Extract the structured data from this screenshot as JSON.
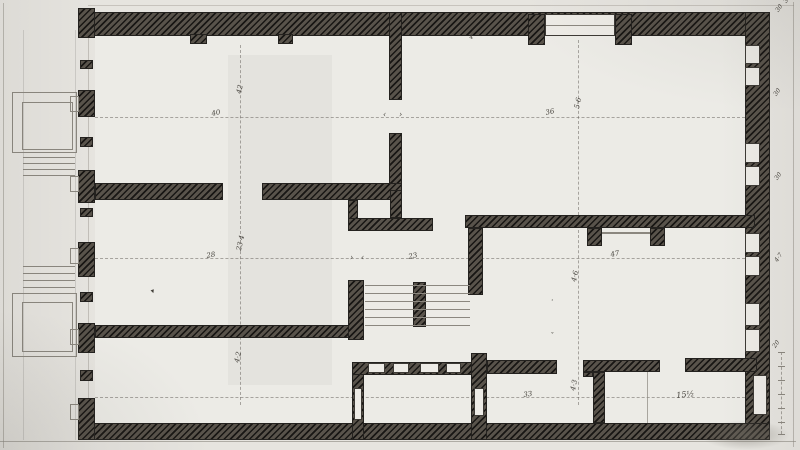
{
  "document": {
    "kind": "scanned hand-drawn architectural floor plan, hatched masonry walls",
    "colors": {
      "paper": "#e6e4df",
      "room_fill": "#ecebe6",
      "wall_ink_dark": "#24221f",
      "wall_ink_mid": "#5a544c",
      "pencil_line": "#8b877f",
      "annotation_ink": "#44413b"
    }
  },
  "annotations": [
    {
      "name": "dim-40",
      "text": "40",
      "x": 211,
      "y": 111,
      "rot": -12,
      "size": 7
    },
    {
      "name": "dim-42",
      "text": "42",
      "x": 236,
      "y": 93,
      "rot": -78,
      "size": 7
    },
    {
      "name": "mark-plus",
      "text": "+",
      "x": 238,
      "y": 16,
      "rot": 0,
      "size": 6
    },
    {
      "name": "dim-36",
      "text": "36",
      "x": 545,
      "y": 110,
      "rot": -12,
      "size": 7
    },
    {
      "name": "dim-5-6",
      "text": "5·6",
      "x": 574,
      "y": 108,
      "rot": -78,
      "size": 7
    },
    {
      "name": "dim-4-door",
      "text": "4",
      "x": 469,
      "y": 35,
      "rot": -10,
      "size": 6
    },
    {
      "name": "arrow-left-top",
      "text": "‹",
      "x": 383,
      "y": 111,
      "rot": 0,
      "size": 8
    },
    {
      "name": "arrow-right-top",
      "text": "›",
      "x": 399,
      "y": 111,
      "rot": 0,
      "size": 8
    },
    {
      "name": "dim-28",
      "text": "28",
      "x": 206,
      "y": 253,
      "rot": -10,
      "size": 7
    },
    {
      "name": "dim-23-4",
      "text": "23·4",
      "x": 236,
      "y": 250,
      "rot": -78,
      "size": 7
    },
    {
      "name": "arrow-right-stair",
      "text": "›",
      "x": 350,
      "y": 254,
      "rot": 0,
      "size": 8
    },
    {
      "name": "arrow-left-stair",
      "text": "‹",
      "x": 361,
      "y": 254,
      "rot": 0,
      "size": 8
    },
    {
      "name": "dim-23",
      "text": "23",
      "x": 408,
      "y": 254,
      "rot": -12,
      "size": 7
    },
    {
      "name": "dim-47",
      "text": "47",
      "x": 610,
      "y": 252,
      "rot": -12,
      "size": 7
    },
    {
      "name": "dim-4-6",
      "text": "4·6",
      "x": 571,
      "y": 281,
      "rot": -78,
      "size": 7
    },
    {
      "name": "ink-mark",
      "text": "▾",
      "x": 150,
      "y": 289,
      "rot": -20,
      "size": 7
    },
    {
      "name": "dim-33",
      "text": "33",
      "x": 523,
      "y": 392,
      "rot": -8,
      "size": 7
    },
    {
      "name": "dim-4-3",
      "text": "4·3",
      "x": 570,
      "y": 390,
      "rot": -78,
      "size": 7
    },
    {
      "name": "dim-15-half",
      "text": "15½",
      "x": 676,
      "y": 392,
      "rot": -6,
      "size": 8
    },
    {
      "name": "dim-4-2",
      "text": "4·2",
      "x": 234,
      "y": 362,
      "rot": -78,
      "size": 7
    },
    {
      "name": "margin-36",
      "text": "36",
      "x": 783,
      "y": 1,
      "rot": -55,
      "size": 6
    },
    {
      "name": "margin-30a",
      "text": "30",
      "x": 775,
      "y": 10,
      "rot": -55,
      "size": 6
    },
    {
      "name": "margin-30b",
      "text": "30",
      "x": 773,
      "y": 94,
      "rot": -55,
      "size": 6
    },
    {
      "name": "margin-30c",
      "text": "30",
      "x": 774,
      "y": 178,
      "rot": -55,
      "size": 6
    },
    {
      "name": "margin-4-7",
      "text": "4·7",
      "x": 774,
      "y": 260,
      "rot": -55,
      "size": 6
    },
    {
      "name": "margin-20",
      "text": "20",
      "x": 772,
      "y": 346,
      "rot": -55,
      "size": 6
    },
    {
      "name": "tick-dot",
      "text": "·",
      "x": 551,
      "y": 297,
      "rot": 0,
      "size": 8
    },
    {
      "name": "tick-caron",
      "text": "ˇ",
      "x": 550,
      "y": 333,
      "rot": 0,
      "size": 7
    }
  ]
}
